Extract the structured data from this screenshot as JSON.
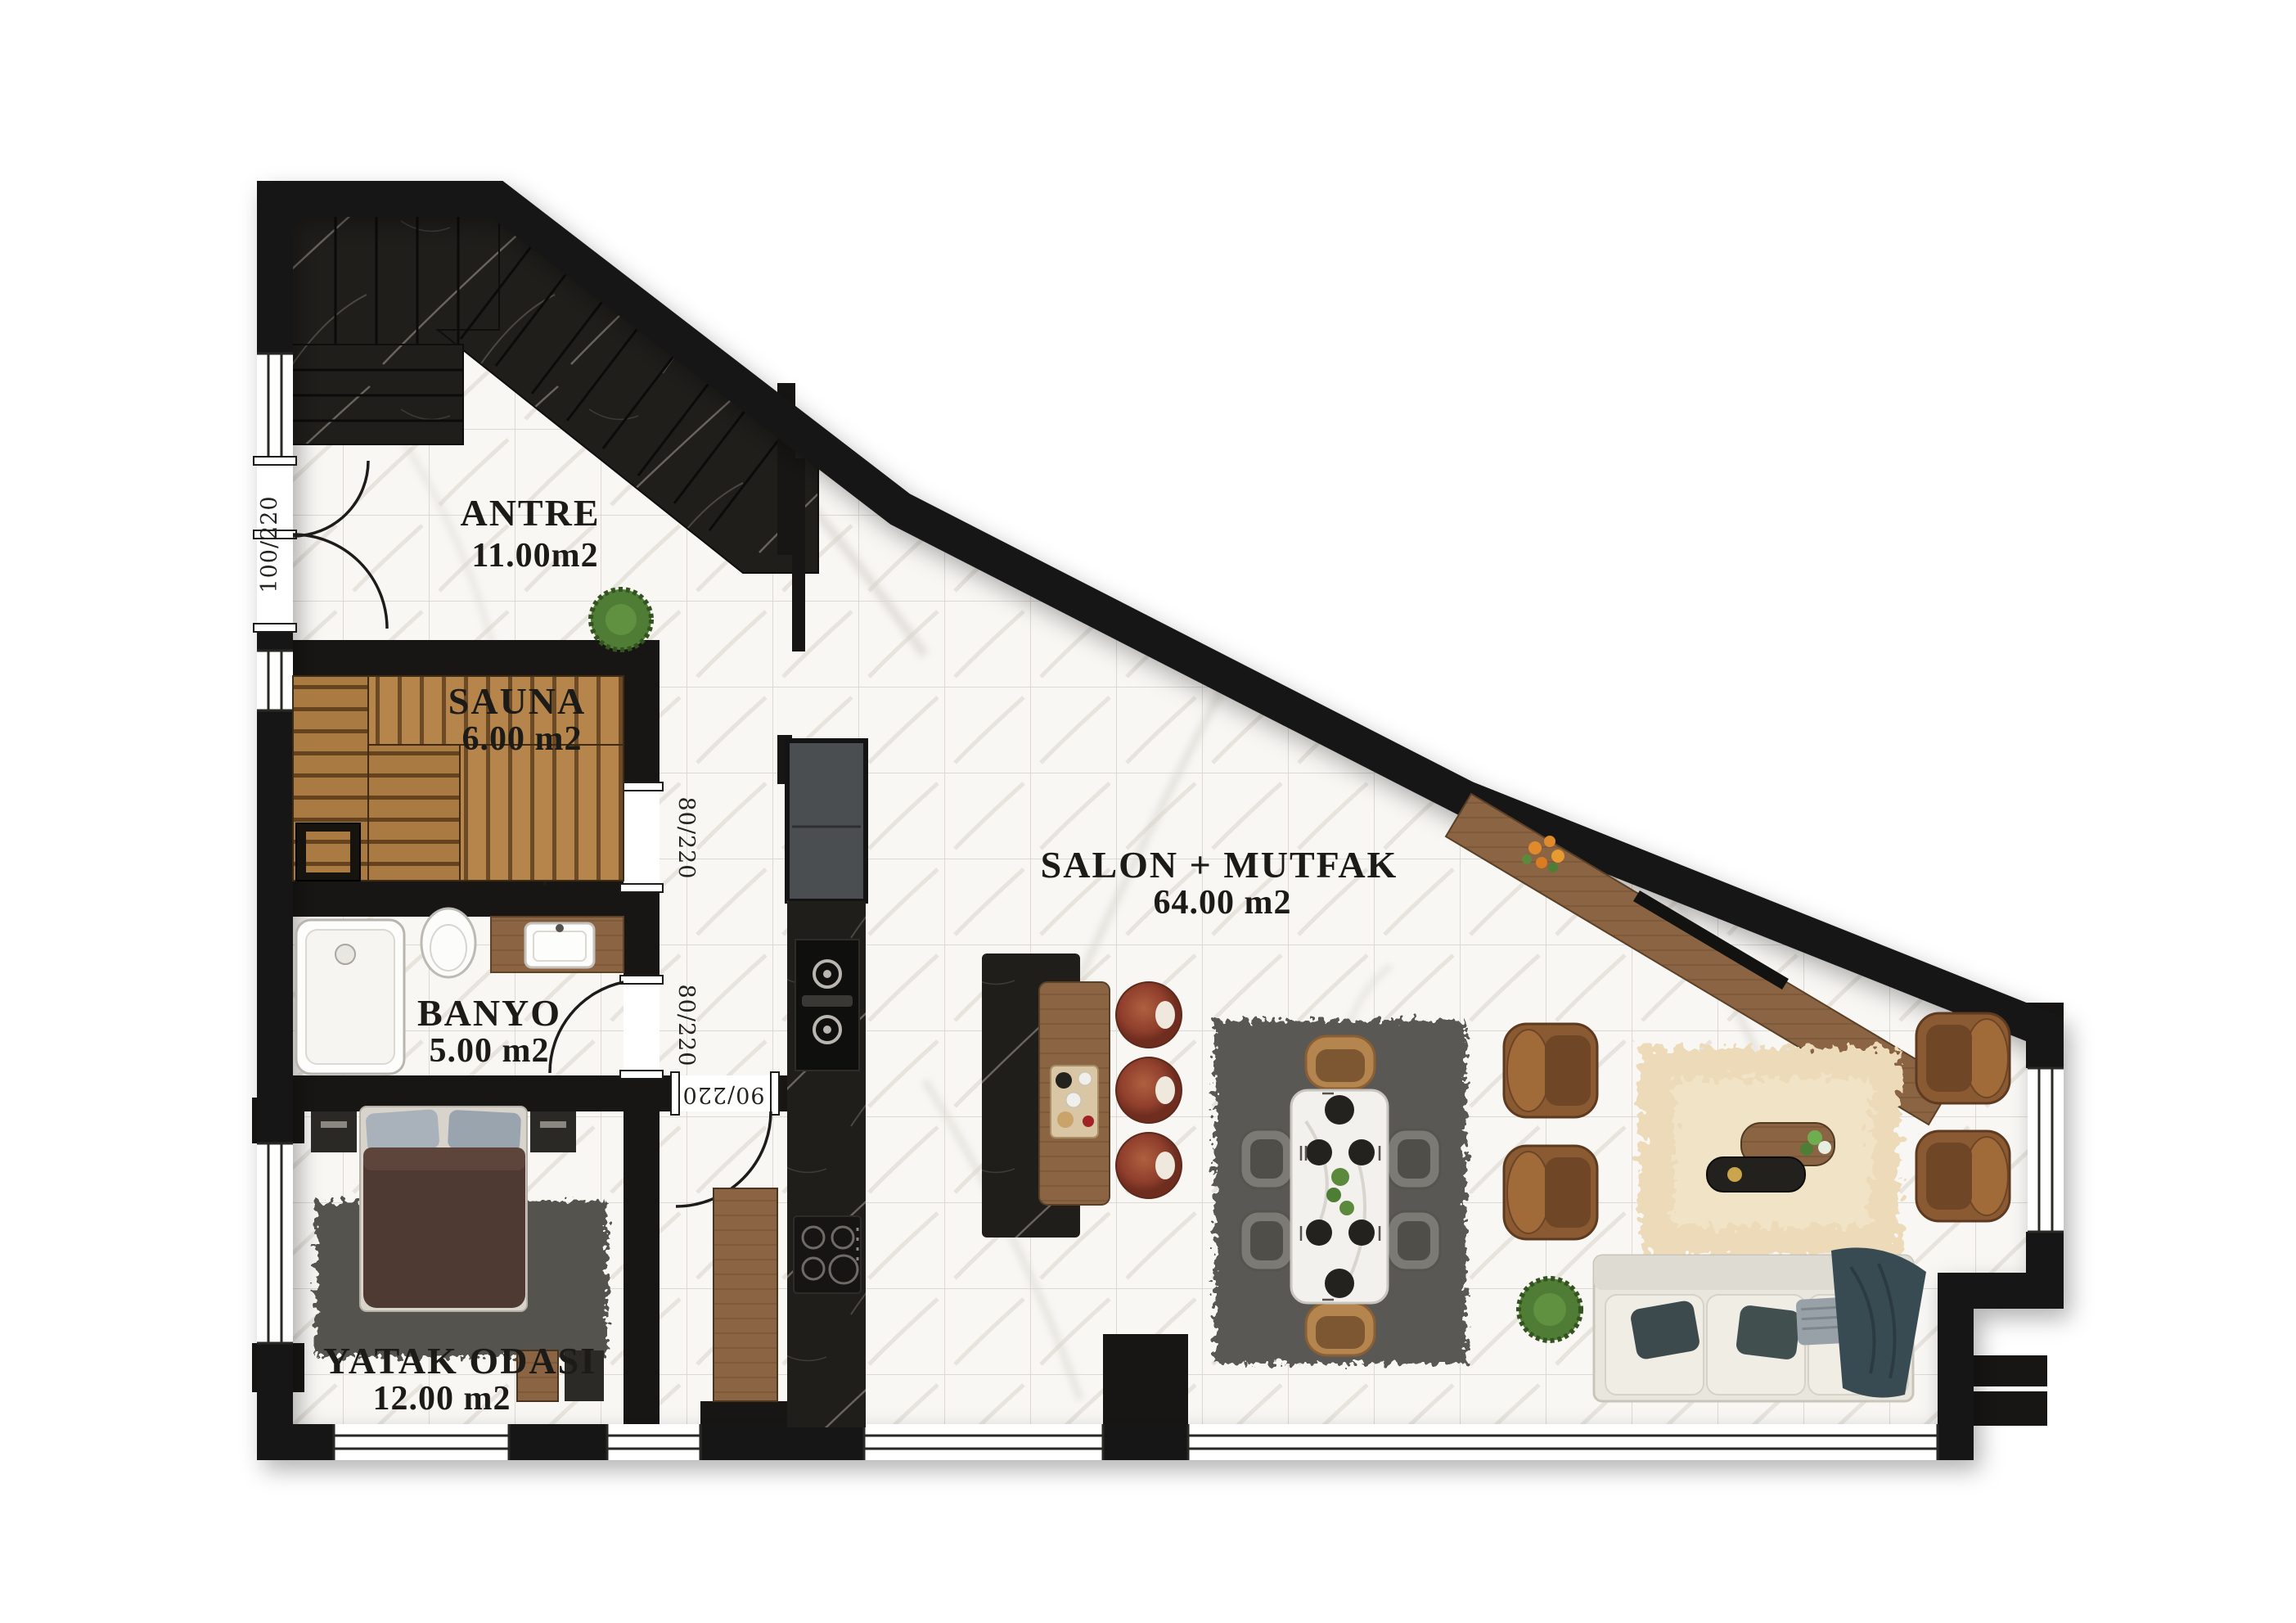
{
  "meta": {
    "type": "apartment-floor-plan",
    "style": "top-down render, marble floor"
  },
  "rooms": [
    {
      "key": "antre",
      "name": "ANTRE",
      "area": "11.00m2"
    },
    {
      "key": "sauna",
      "name": "SAUNA",
      "area": "6.00 m2"
    },
    {
      "key": "banyo",
      "name": "BANYO",
      "area": "5.00 m2"
    },
    {
      "key": "salon",
      "name": "SALON + MUTFAK",
      "area": "64.00 m2"
    },
    {
      "key": "yatak",
      "name": "YATAK ODASI",
      "area": "12.00 m2"
    }
  ],
  "doors": [
    {
      "key": "entry",
      "label": "100/220"
    },
    {
      "key": "sauna-door",
      "label": "80/220"
    },
    {
      "key": "banyo-door",
      "label": "80/220"
    },
    {
      "key": "bedroom-door",
      "label": "90/220"
    }
  ],
  "palette": {
    "wall": "#171614",
    "floor": "#f8f7f4",
    "grout": "#dcd9d3",
    "darkMarble": "#201e1b",
    "saunaWood": "#a87a46",
    "leather": "#8a5a33",
    "sofa": "#e9e6de",
    "rugGray": "#5a5954",
    "rugCream": "#ecdab8",
    "plantGreen": "#507d36",
    "stoolRed": "#97422e"
  }
}
